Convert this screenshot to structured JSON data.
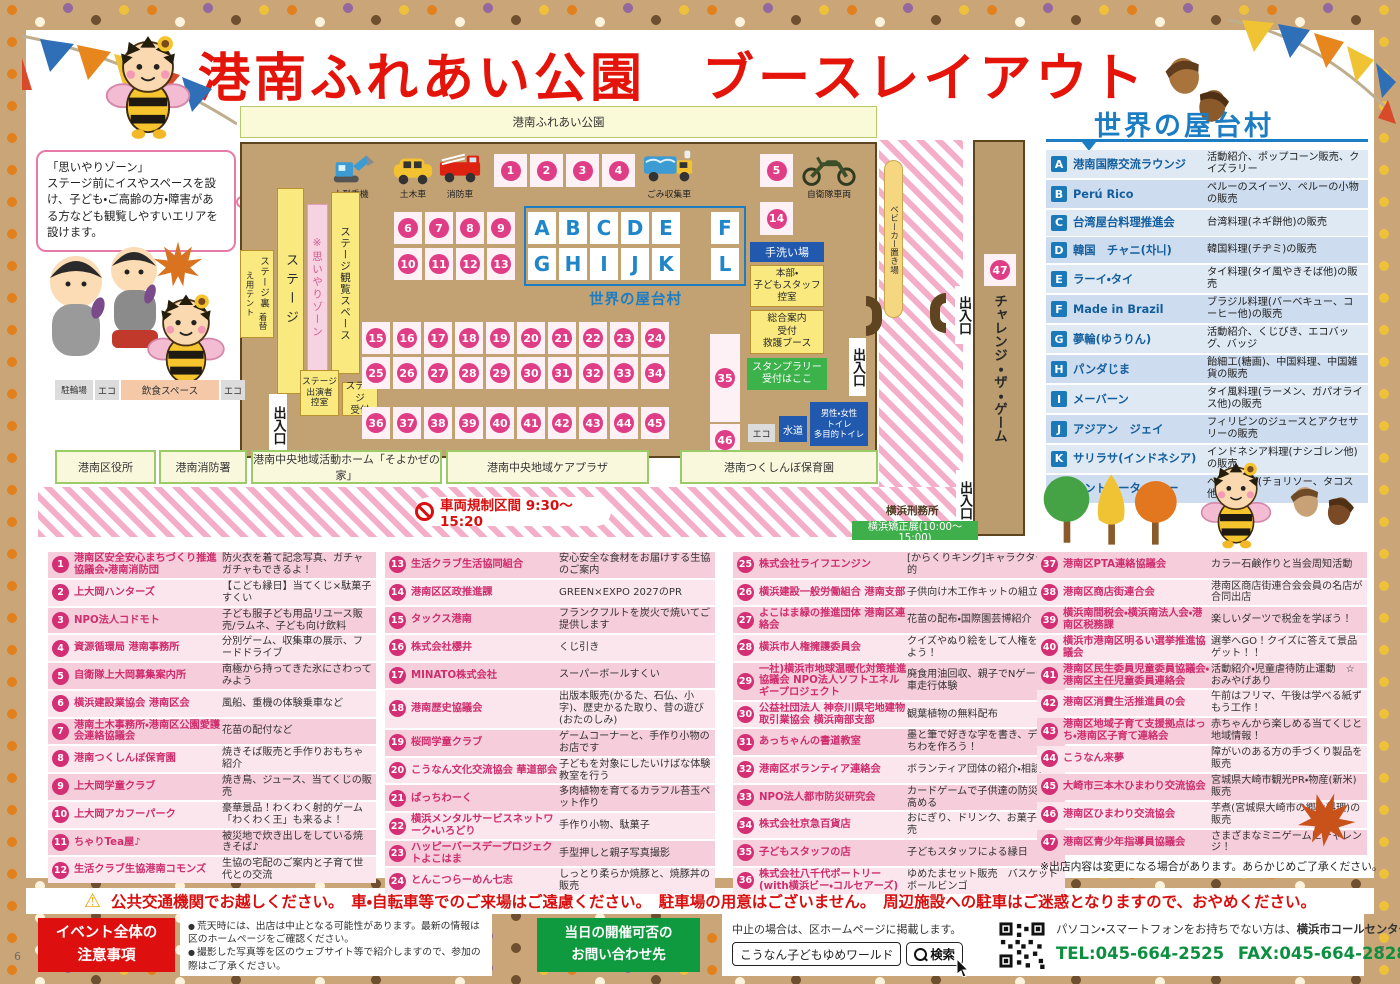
{
  "page": {
    "title": "港南ふれあい公園　ブースレイアウト",
    "page_no_left": "6",
    "page_no_right": "7"
  },
  "omoiyari_box": "「思いやりゾーン」\nステージ前にイスやスペースを設け、子ども・ご高齢の方・障害がある方なども観覧しやすいエリアを設けます。",
  "map": {
    "park_label": "港南ふれあい公園",
    "vehicles": [
      {
        "name": "小型重機"
      },
      {
        "name": "土木車"
      },
      {
        "name": "消防車"
      },
      {
        "name": "ごみ収集車"
      },
      {
        "name": "自衛隊車両"
      }
    ],
    "cells": {
      "row1_4": [
        "1",
        "2",
        "3",
        "4"
      ],
      "cell5": "5",
      "row6_9": [
        "6",
        "7",
        "8",
        "9"
      ],
      "lettersAE": [
        "A",
        "B",
        "C",
        "D",
        "E"
      ],
      "cellF": "F",
      "row10_13": [
        "10",
        "11",
        "12",
        "13"
      ],
      "lettersGK": [
        "G",
        "H",
        "I",
        "J",
        "K"
      ],
      "cellL": "L",
      "cell14": "14",
      "row15_24": [
        "15",
        "16",
        "17",
        "18",
        "19",
        "20",
        "21",
        "22",
        "23",
        "24"
      ],
      "row25_34": [
        "25",
        "26",
        "27",
        "28",
        "29",
        "30",
        "31",
        "32",
        "33",
        "34"
      ],
      "cell35": "35",
      "row36_45": [
        "36",
        "37",
        "38",
        "39",
        "40",
        "41",
        "42",
        "43",
        "44",
        "45"
      ],
      "cell46": "46",
      "cell47": "47"
    },
    "yatai_label": "世界の屋台村",
    "labels": {
      "stage_back": "ステージ裏",
      "tent": "着替え用テント",
      "stage": "ステージ",
      "omoiyari_zone": "※思いやりゾーン",
      "stage_view": "ステージ観覧スペース",
      "stage_staff": "ステージ\n出演者\n控室",
      "stage_reception": "ステージ\n受付",
      "exit": "出入口",
      "hand_wash": "手洗い場",
      "hq": "本部・\n子どもスタッフ\n控室",
      "info": "総合案内\n受付\n救護ブース",
      "stamp_rally": "スタンプラリー\n受付はここ",
      "stroller": "ベビーカー置き場",
      "challenge": "チャレンジ・ザ・ゲーム",
      "bike_parking": "駐輪場",
      "eco": "エコ",
      "dining": "飲食スペース",
      "water": "水道",
      "toilet": "男性・女性\nトイレ\n多目的トイレ"
    }
  },
  "surroundings": {
    "buildings": [
      "港南区役所",
      "港南消防署",
      "港南中央地域活動ホーム「そよかぜの家」",
      "港南中央地域ケアプラザ",
      "港南つくしんぼ保育園"
    ],
    "prison": "横浜刑務所",
    "exhibition": "横浜矯正展(10:00～15:00)",
    "restriction": "車両規制区間 9:30～15:20"
  },
  "world_stalls": {
    "title": "世界の屋台村",
    "items": [
      {
        "letter": "A",
        "name": "港南国際交流ラウンジ",
        "desc": "活動紹介、ポップコーン販売、クイズラリー"
      },
      {
        "letter": "B",
        "name": "Perú Rico",
        "desc": "ペルーのスイーツ、ペルーの小物の販売"
      },
      {
        "letter": "C",
        "name": "台湾屋台料理推進会",
        "desc": "台湾料理(ネギ餅他)の販売"
      },
      {
        "letter": "D",
        "name": "韓国　チャニ(차니)",
        "desc": "韓国料理(チヂミ)の販売"
      },
      {
        "letter": "E",
        "name": "ラーイ・タイ",
        "desc": "タイ料理(タイ風やきそば他)の販売"
      },
      {
        "letter": "F",
        "name": "Made in Brazil",
        "desc": "ブラジル料理(バーベキュー、コーヒー他)の販売"
      },
      {
        "letter": "G",
        "name": "夢輪(ゆうりん)",
        "desc": "活動紹介、くじびき、エコバッグ、バッジ"
      },
      {
        "letter": "H",
        "name": "パンダじま",
        "desc": "飴細工(糖画)、中国料理、中国雑貨の販売"
      },
      {
        "letter": "I",
        "name": "メーバーン",
        "desc": "タイ風料理(ラーメン、ガパオライス他)の販売"
      },
      {
        "letter": "J",
        "name": "アジアン　ジェイ",
        "desc": "フィリピンのジュースとアクセサリーの販売"
      },
      {
        "letter": "K",
        "name": "サリラサ(インドネシア)",
        "desc": "インドネシア料理(ナシゴレン他)の販売"
      },
      {
        "letter": "L",
        "name": "カントゥータ・ペルー",
        "desc": "ペルー料理(チョリソー、タコス他)の販売"
      }
    ]
  },
  "booths": [
    {
      "num": "1",
      "name": "港南区安全安心まちづくり推進協議会・港南消防団",
      "desc": "防火衣を着て記念写真、ガチャガチャもできるよ！"
    },
    {
      "num": "2",
      "name": "上大岡ハンターズ",
      "desc": "【こども縁日】当てくじ×駄菓子すくい"
    },
    {
      "num": "3",
      "name": "NPO法人コドモト",
      "desc": "子ども服子ども用品リユース販売/ラムネ、子ども向け飲料"
    },
    {
      "num": "4",
      "name": "資源循環局 港南事務所",
      "desc": "分別ゲーム、収集車の展示、フードドライブ"
    },
    {
      "num": "5",
      "name": "自衛隊上大岡募集案内所",
      "desc": "南極から持ってきた氷にさわってみよう"
    },
    {
      "num": "6",
      "name": "横浜建設業協会 港南区会",
      "desc": "風船、重機の体験乗車など"
    },
    {
      "num": "7",
      "name": "港南土木事務所・港南区公園愛護会連絡協議会",
      "desc": "花苗の配付など"
    },
    {
      "num": "8",
      "name": "港南つくしんぼ保育園",
      "desc": "焼きそば販売と手作りおもちゃ紹介"
    },
    {
      "num": "9",
      "name": "上大岡学童クラブ",
      "desc": "焼き鳥、ジュース、当てくじの販売"
    },
    {
      "num": "10",
      "name": "上大岡アカフーパーク",
      "desc": "豪華景品！わくわく射的ゲーム「わくわく王」も来るよ！"
    },
    {
      "num": "11",
      "name": "ちゃりTea屋♪",
      "desc": "被災地で炊き出しをしている焼きそば♪"
    },
    {
      "num": "12",
      "name": "生活クラブ生協港南コモンズ",
      "desc": "生協の宅配のご案内と子育て世代との交流"
    },
    {
      "num": "13",
      "name": "生活クラブ生活協同組合",
      "desc": "安心安全な食材をお届けする生協のご案内"
    },
    {
      "num": "14",
      "name": "港南区区政推進課",
      "desc": "GREEN×EXPO 2027のPR"
    },
    {
      "num": "15",
      "name": "タックス港南",
      "desc": "フランクフルトを炭火で焼いてご提供します"
    },
    {
      "num": "16",
      "name": "株式会社櫻井",
      "desc": "くじ引き"
    },
    {
      "num": "17",
      "name": "MINATO株式会社",
      "desc": "スーパーボールすくい"
    },
    {
      "num": "18",
      "name": "港南歴史協議会",
      "desc": "出版本販売(かるた、石仏、小字)、歴史かるた取り、昔の遊び(おたのしみ)"
    },
    {
      "num": "19",
      "name": "桜岡学童クラブ",
      "desc": "ゲームコーナーと、手作り小物のお店です"
    },
    {
      "num": "20",
      "name": "こうなん文化交流協会 華道部会",
      "desc": "子どもを対象にしたいけばな体験教室を行う"
    },
    {
      "num": "21",
      "name": "ぱっちわーく",
      "desc": "多肉植物を育てるカラフル苔玉ペット作り"
    },
    {
      "num": "22",
      "name": "横浜メンタルサービスネットワーク・いろどり",
      "desc": "手作り小物、駄菓子"
    },
    {
      "num": "23",
      "name": "ハッピーバースデープロジェクトよこはま",
      "desc": "手型押しと親子写真撮影"
    },
    {
      "num": "24",
      "name": "とんこつらーめん七志",
      "desc": "しっとり柔らか焼豚と、焼豚丼の販売"
    },
    {
      "num": "25",
      "name": "株式会社ライフエンジン",
      "desc": "[からくりキング]キャラクター射的"
    },
    {
      "num": "26",
      "name": "横浜建設一般労働組合 港南支部",
      "desc": "子供向け木工作キットの組立て"
    },
    {
      "num": "27",
      "name": "よこはま緑の推進団体 港南区連絡会",
      "desc": "花苗の配布・国際園芸博紹介"
    },
    {
      "num": "28",
      "name": "横浜市人権擁護委員会",
      "desc": "クイズやぬり絵をして人権を考えよう！"
    },
    {
      "num": "29",
      "name": "一社)横浜市地球温暖化対策推進協議会 NPO法人ソフトエネルギープロジェクト",
      "desc": "廃食用油回収、親子でNゲージ電車走行体験"
    },
    {
      "num": "30",
      "name": "公益社団法人 神奈川県宅地建物取引業協会 横浜南部支部",
      "desc": "観葉植物の無料配布"
    },
    {
      "num": "31",
      "name": "あっちゃんの書道教室",
      "desc": "墨と筆で好きな字を書き、デコうちわを作ろう！"
    },
    {
      "num": "32",
      "name": "港南区ボランティア連絡会",
      "desc": "ボランティア団体の紹介・相談"
    },
    {
      "num": "33",
      "name": "NPO法人都市防災研究会",
      "desc": "カードゲームで子供達の防災力を高める"
    },
    {
      "num": "34",
      "name": "株式会社京急百貨店",
      "desc": "おにぎり、ドリンク、お菓子の販売"
    },
    {
      "num": "35",
      "name": "子どもスタッフの店",
      "desc": "子どもスタッフによる縁日"
    },
    {
      "num": "36",
      "name": "株式会社八千代ポートリー(with横浜ビー・コルセアーズ)",
      "desc": "ゆめたまセット販売　バスケットボールビンゴ"
    },
    {
      "num": "37",
      "name": "港南区PTA連絡協議会",
      "desc": "カラー石鹸作りと当会周知活動"
    },
    {
      "num": "38",
      "name": "港南区商店街連合会",
      "desc": "港南区商店街連合会会員の名店が合同出店"
    },
    {
      "num": "39",
      "name": "横浜南間税会・横浜南法人会・港南区税務課",
      "desc": "楽しいダーツで税金を学ぼう！"
    },
    {
      "num": "40",
      "name": "横浜市港南区明るい選挙推進協議会",
      "desc": "選挙へGO！クイズに答えて景品ゲット！！"
    },
    {
      "num": "41",
      "name": "港南区民生委員児童委員協議会・港南区主任児童委員連絡会",
      "desc": "活動紹介・児童虐待防止運動　☆おみやげあり"
    },
    {
      "num": "42",
      "name": "港南区消費生活推進員の会",
      "desc": "午前はフリマ、午後は学べる紙ずもう工作！"
    },
    {
      "num": "43",
      "name": "港南区地域子育て支援拠点はっち・港南区子育て連絡会",
      "desc": "赤ちゃんから楽しめる当てくじと地域情報！"
    },
    {
      "num": "44",
      "name": "こうなん来夢",
      "desc": "障がいのある方の手づくり製品を販売"
    },
    {
      "num": "45",
      "name": "大崎市三本木ひまわり交流協会",
      "desc": "宮城県大崎市観光PR・物産(新米)販売"
    },
    {
      "num": "46",
      "name": "港南区ひまわり交流協会",
      "desc": "芋煮(宮城県大崎市の郷土料理)の販売"
    },
    {
      "num": "47",
      "name": "港南区青少年指導員協議会",
      "desc": "さまざまなミニゲームにチャレンジ！"
    }
  ],
  "booth_columns": [
    {
      "start": 0,
      "count": 12
    },
    {
      "start": 12,
      "count": 12
    },
    {
      "start": 24,
      "count": 12
    },
    {
      "start": 36,
      "count": 11
    }
  ],
  "disclaimer": "※出店内容は変更になる場合があります。あらかじめご了承ください。",
  "footer": {
    "transport_warning": "公共交通機関でお越しください。　車・自転車等でのご来場はご遠慮ください。　駐車場の用意はございません。　周辺施設への駐車はご迷惑となりますので、おやめください。",
    "notice_title": "イベント全体の\n注意事項",
    "notices": [
      "荒天時には、出店は中止となる可能性があります。最新の情報は区のホームページをご確認ください。",
      "撮影した写真等を区のウェブサイト等で紹介しますので、参加の際はご了承ください。"
    ],
    "contact_title": "当日の開催可否の\nお問い合わせ先",
    "cancel_note": "中止の場合は、区ホームページに掲載します。",
    "search_value": "こうなん子どもゆめワールド",
    "search_button": "検索",
    "call_center_note": "パソコン・スマートフォンをお持ちでない方は、",
    "call_center_name": "横浜市コールセンター",
    "tel": "TEL:045-664-2525",
    "fax": "FAX:045-664-2828",
    "tel_badge": "11月1日 午前8時からのみ"
  }
}
